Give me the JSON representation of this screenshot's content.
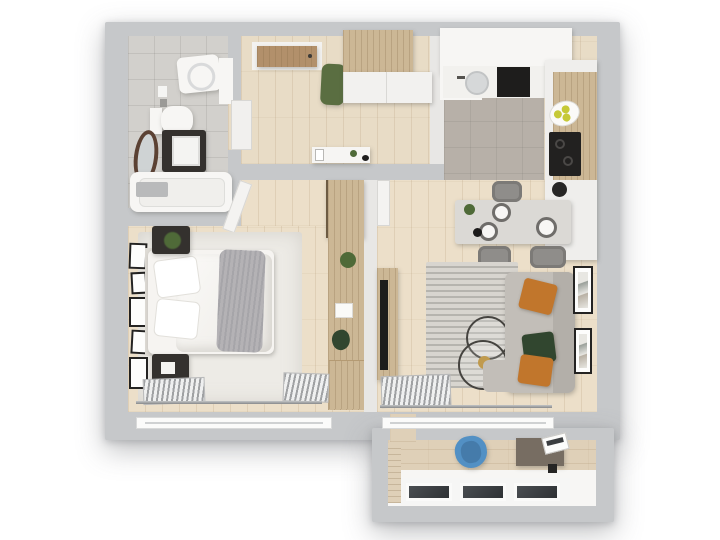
{
  "scene": {
    "type": "apartment-floor-plan-3d-top-view",
    "rooms": [
      {
        "id": "bathroom",
        "items": [
          "washing-machine",
          "toilet",
          "sink-vanity",
          "standing-mirror",
          "bathtub",
          "shower-seat"
        ]
      },
      {
        "id": "hallway",
        "items": [
          "entrance-door",
          "green-ottoman",
          "wardrobe",
          "white-cabinet",
          "console-table",
          "bathroom-door-leaf"
        ]
      },
      {
        "id": "kitchen",
        "items": [
          "upper-cabinets",
          "sink",
          "oven",
          "cooktop",
          "fruit-plate",
          "kettle",
          "tall-cabinets",
          "dining-table",
          "plates",
          "chairs"
        ]
      },
      {
        "id": "bedroom",
        "items": [
          "double-bed",
          "pillows",
          "gray-throw",
          "nightstand-with-plant",
          "nightstand-with-photo",
          "gallery-wall-frames",
          "area-rug",
          "wall-desk",
          "plants",
          "radiators",
          "window"
        ]
      },
      {
        "id": "living-room",
        "items": [
          "corner-sofa",
          "orange-pillows",
          "green-pillow",
          "tv-console",
          "tv",
          "striped-rug",
          "round-coffee-tables",
          "wall-frames",
          "radiator",
          "window"
        ]
      },
      {
        "id": "balcony",
        "items": [
          "office-chair",
          "desk",
          "laptop",
          "window-band"
        ]
      }
    ]
  },
  "palette": {
    "background": "#ffffff",
    "wall": "#c6c8ca",
    "wall_inner": "#e8e7e5",
    "floor_wood": "#e8dcc6",
    "floor_wood_light": "#ecdfc9",
    "floor_tile_bath": "#d2d0cc",
    "floor_tile_kitchen": "#b7b0a8",
    "rug_bedroom": "#edebe6",
    "rug_living": "#d8d5cf",
    "furniture_white": "#f7f6f4",
    "furniture_wood": "#ccb795",
    "furniture_dark": "#34312e",
    "door_wood": "#b2906b",
    "accent_green": "#5a6e41",
    "plant_green": "#4f6a38",
    "pillow_orange": "#c1762c",
    "pillow_green": "#31462f",
    "sofa_gray": "#c2beb8",
    "chair_blue": "#5290c4",
    "bed_white": "#f6f4f1",
    "throw_gray": "#b4b2b5",
    "fruit_yellow": "#c6c937",
    "metal": "#9fa1a3",
    "balcony_floor": "#dfd0b8"
  }
}
